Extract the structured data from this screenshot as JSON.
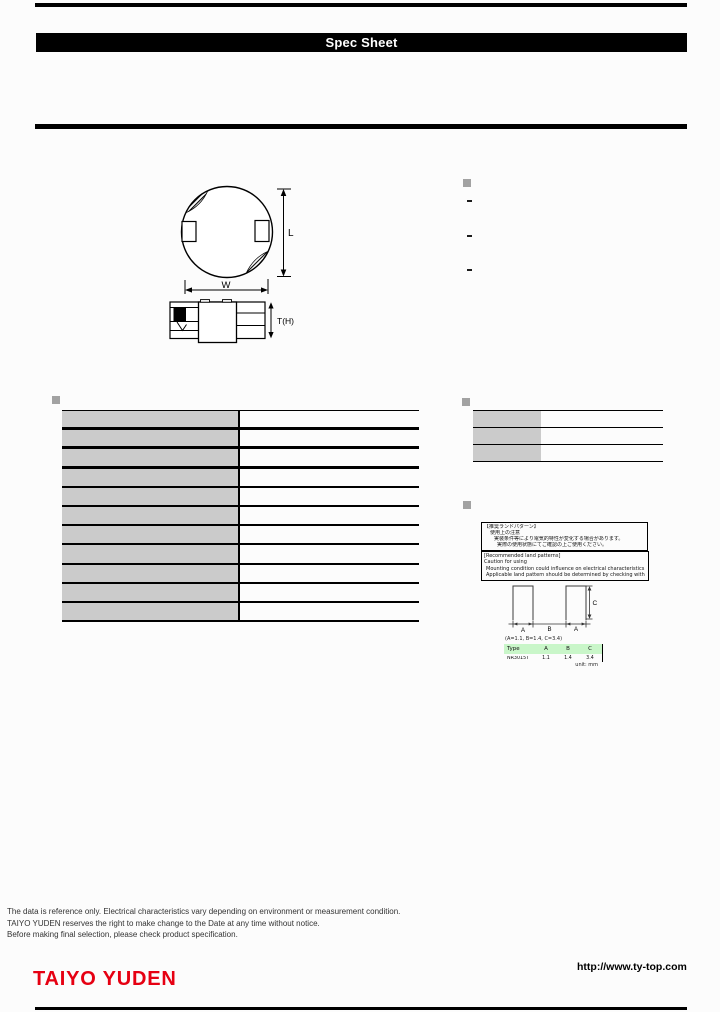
{
  "header": {
    "title": "Spec Sheet"
  },
  "package_diagram": {
    "length_label": "L",
    "width_label": "W",
    "thickness_label": "T(H)"
  },
  "features": {
    "items": [
      "-",
      "-",
      "-"
    ]
  },
  "notes": {
    "jp_box_lines": [
      "【推奨ランドパターン】",
      "使用上の注意",
      "実装条件等により電気的特性が変化する場合があります。",
      "実際の使用状態にてご確認の上ご使用ください。"
    ],
    "en_box_lines": [
      "[Recommended land patterns]",
      "Caution for using",
      "Mounting condition could influence on electrical characteristics and performance.",
      "Applicable land pattern should be determined by checking with the actual board design."
    ]
  },
  "land_pattern": {
    "dim_a_label": "A",
    "dim_b_label": "B",
    "dim_c_label": "C",
    "note_line": "(A=1.1, B=1.4, C=3.4)",
    "table": {
      "headers": [
        "Type",
        "A",
        "B",
        "C"
      ],
      "row": [
        "NR3015T",
        "1.1",
        "1.4",
        "3.4"
      ],
      "unit_note": "unit: mm"
    }
  },
  "footer": {
    "disclaimer_lines": [
      "The data is reference only. Electrical characteristics vary depending on environment or measurement condition.",
      "TAIYO YUDEN reserves the right to make change to the Date at any time without notice.",
      "Before making final selection, please check product specification."
    ],
    "logo_text": "TAIYO YUDEN",
    "website_url": "http://www.ty-top.com",
    "brand_color": "#e60012"
  }
}
